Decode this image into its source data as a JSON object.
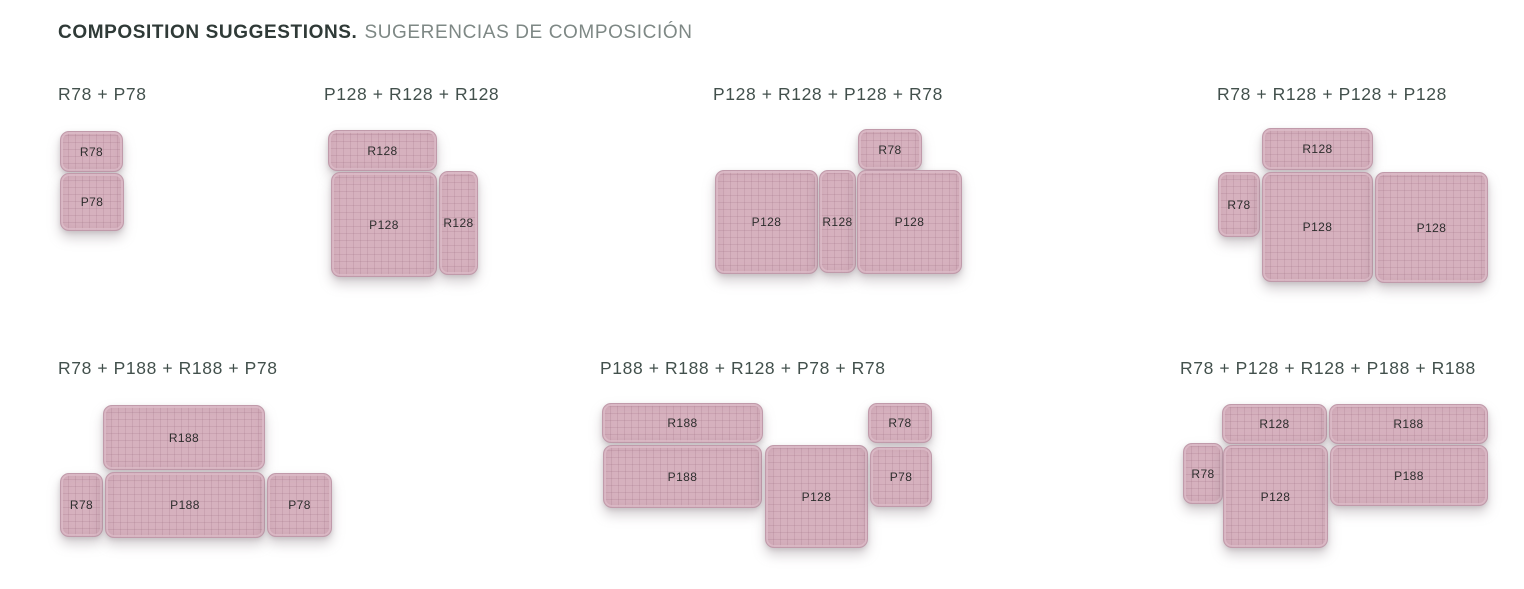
{
  "header": {
    "title_en": "COMPOSITION SUGGESTIONS.",
    "title_es": "SUGERENCIAS DE COMPOSICIÓN"
  },
  "colors": {
    "module_fill": "#d6b1be",
    "module_grid": "#c49eae",
    "module_border": "#c09aaa",
    "heading_text": "#42504c",
    "title_en_text": "#2f3a37",
    "title_es_text": "#7e8885",
    "label_text": "#2d2d2d"
  },
  "compositions": [
    {
      "heading": "R78 + P78",
      "heading_x": 58,
      "heading_y": 84,
      "modules": [
        {
          "label": "R78",
          "x": 60,
          "y": 131,
          "w": 63,
          "h": 41
        },
        {
          "label": "P78",
          "x": 60,
          "y": 173,
          "w": 64,
          "h": 58
        }
      ]
    },
    {
      "heading": "P128 + R128 + R128",
      "heading_x": 324,
      "heading_y": 84,
      "modules": [
        {
          "label": "R128",
          "x": 328,
          "y": 130,
          "w": 109,
          "h": 41
        },
        {
          "label": "P128",
          "x": 331,
          "y": 172,
          "w": 106,
          "h": 105
        },
        {
          "label": "R128",
          "x": 439,
          "y": 171,
          "w": 39,
          "h": 104
        }
      ]
    },
    {
      "heading": "P128 + R128 + P128 + R78",
      "heading_x": 713,
      "heading_y": 84,
      "modules": [
        {
          "label": "R78",
          "x": 858,
          "y": 129,
          "w": 64,
          "h": 41
        },
        {
          "label": "P128",
          "x": 715,
          "y": 170,
          "w": 103,
          "h": 104
        },
        {
          "label": "R128",
          "x": 819,
          "y": 170,
          "w": 37,
          "h": 103
        },
        {
          "label": "P128",
          "x": 857,
          "y": 170,
          "w": 105,
          "h": 104
        }
      ]
    },
    {
      "heading": "R78 + R128 + P128 + P128",
      "heading_x": 1217,
      "heading_y": 84,
      "modules": [
        {
          "label": "R128",
          "x": 1262,
          "y": 128,
          "w": 111,
          "h": 42
        },
        {
          "label": "R78",
          "x": 1218,
          "y": 172,
          "w": 42,
          "h": 65
        },
        {
          "label": "P128",
          "x": 1262,
          "y": 172,
          "w": 111,
          "h": 110
        },
        {
          "label": "P128",
          "x": 1375,
          "y": 172,
          "w": 113,
          "h": 111
        }
      ]
    },
    {
      "heading": "R78 + P188 + R188 + P78",
      "heading_x": 58,
      "heading_y": 358,
      "modules": [
        {
          "label": "R188",
          "x": 103,
          "y": 405,
          "w": 162,
          "h": 65
        },
        {
          "label": "R78",
          "x": 60,
          "y": 473,
          "w": 43,
          "h": 64
        },
        {
          "label": "P188",
          "x": 105,
          "y": 472,
          "w": 160,
          "h": 66
        },
        {
          "label": "P78",
          "x": 267,
          "y": 473,
          "w": 65,
          "h": 64
        }
      ]
    },
    {
      "heading": "P188 + R188 + R128 + P78 + R78",
      "heading_x": 600,
      "heading_y": 358,
      "modules": [
        {
          "label": "R188",
          "x": 602,
          "y": 403,
          "w": 161,
          "h": 40
        },
        {
          "label": "P188",
          "x": 603,
          "y": 445,
          "w": 159,
          "h": 63
        },
        {
          "label": "P128",
          "x": 765,
          "y": 445,
          "w": 103,
          "h": 103
        },
        {
          "label": "R78",
          "x": 868,
          "y": 403,
          "w": 64,
          "h": 40
        },
        {
          "label": "P78",
          "x": 870,
          "y": 447,
          "w": 62,
          "h": 60
        }
      ]
    },
    {
      "heading": "R78 + P128 + R128 + P188 + R188",
      "heading_x": 1180,
      "heading_y": 358,
      "modules": [
        {
          "label": "R128",
          "x": 1222,
          "y": 404,
          "w": 105,
          "h": 40
        },
        {
          "label": "R188",
          "x": 1329,
          "y": 404,
          "w": 159,
          "h": 40
        },
        {
          "label": "R78",
          "x": 1183,
          "y": 443,
          "w": 40,
          "h": 61
        },
        {
          "label": "P128",
          "x": 1223,
          "y": 445,
          "w": 105,
          "h": 103
        },
        {
          "label": "P188",
          "x": 1330,
          "y": 445,
          "w": 158,
          "h": 61
        }
      ]
    }
  ]
}
